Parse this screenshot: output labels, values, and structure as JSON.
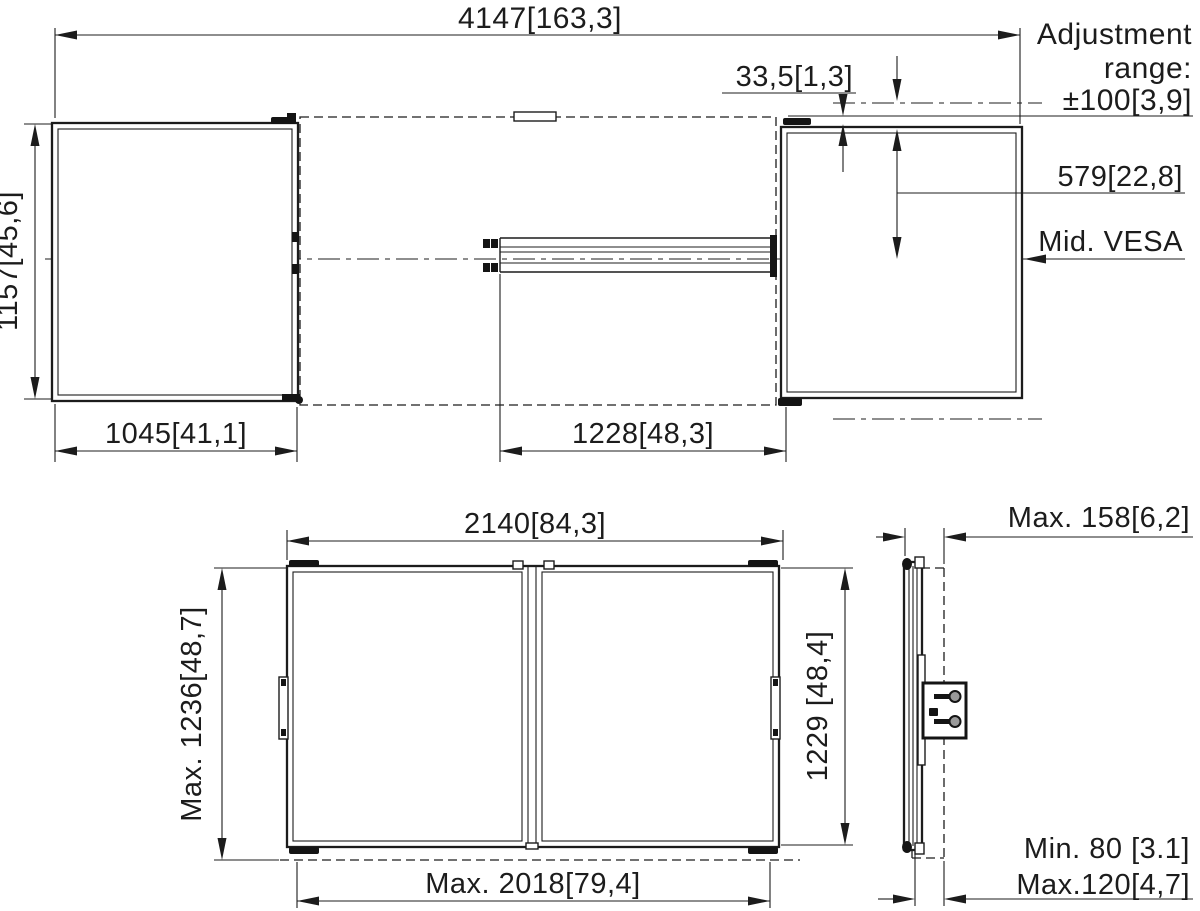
{
  "colors": {
    "line": "#1c1c1c",
    "background": "#ffffff"
  },
  "top_view": {
    "total_width": "4147[163,3]",
    "bracket_offset": "33,5[1,3]",
    "adjustment_line1": "Adjustment",
    "adjustment_line2": "range:",
    "adjustment_value": "±100[3,9]",
    "top_to_vesa": "579[22,8]",
    "mid_vesa": "Mid. VESA",
    "display_height": "1157[45,6]",
    "display_width": "1045[41,1]",
    "rail_span": "1228[48,3]"
  },
  "bottom_view": {
    "board_width": "2140[84,3]",
    "max_height": "Max. 1236[48,7]",
    "board_height": "1229 [48,4]",
    "max_depth": "Max. 158[6,2]",
    "max_inner_width": "Max. 2018[79,4]",
    "wall_distance_min": "Min. 80 [3.1]",
    "wall_distance_max": "Max.120[4,7]"
  }
}
